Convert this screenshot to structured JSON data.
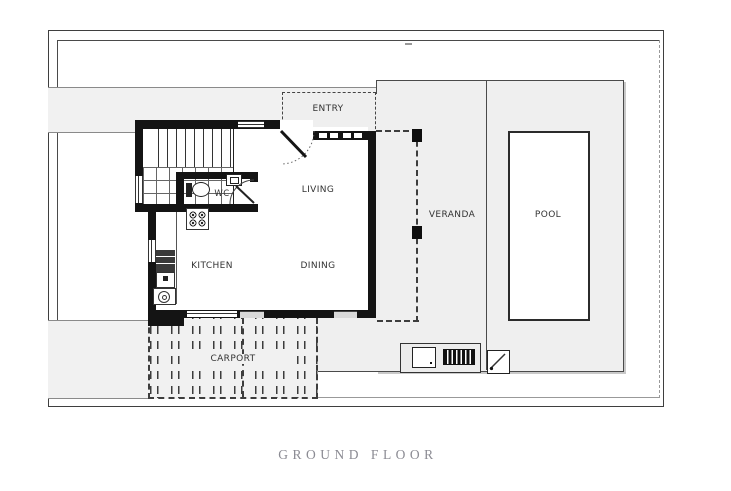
{
  "caption": "GROUND FLOOR",
  "rooms": {
    "entry": {
      "label": "ENTRY"
    },
    "living": {
      "label": "LIVING"
    },
    "dining": {
      "label": "DINING"
    },
    "kitchen": {
      "label": "KITCHEN"
    },
    "wc": {
      "label": "WC"
    },
    "veranda": {
      "label": "VERANDA"
    },
    "pool": {
      "label": "POOL"
    },
    "carport": {
      "label": "CARPORT"
    }
  },
  "colors": {
    "wall": "#141414",
    "paving": "#f1f1f1",
    "yard": "#efefef",
    "frame": "#3f3f3f",
    "caption_text": "#8b8b93"
  }
}
